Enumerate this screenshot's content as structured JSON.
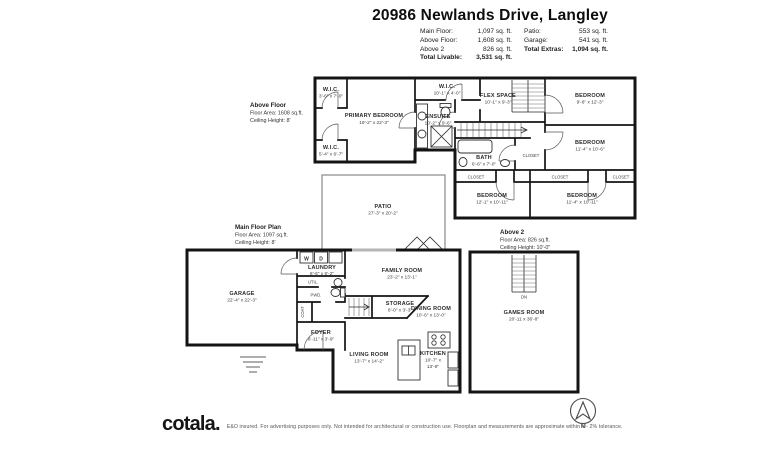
{
  "header": {
    "title": "20986 Newlands Drive, Langley",
    "stats_left": [
      {
        "label": "Main Floor:",
        "value": "1,097 sq. ft."
      },
      {
        "label": "Above Floor:",
        "value": "1,608 sq. ft."
      },
      {
        "label": "Above 2",
        "value": "826 sq. ft."
      },
      {
        "label": "Total Livable:",
        "value": "3,531 sq. ft."
      }
    ],
    "stats_right": [
      {
        "label": "Patio:",
        "value": "553 sq. ft."
      },
      {
        "label": "Garage:",
        "value": "541 sq. ft."
      },
      {
        "label": "Total Extras:",
        "value": "1,094 sq. ft."
      }
    ]
  },
  "plans": {
    "above": {
      "title": "Above Floor",
      "area": "Floor Area: 1608 sq.ft.",
      "ceiling": "Ceiling Height: 8'",
      "rooms": {
        "wic1": {
          "n": "W.I.C.",
          "d": "3'-6\" x 7'-0\""
        },
        "primary": {
          "n": "PRIMARY BEDROOM",
          "d": "19'-2\" x 22'-3\""
        },
        "wic2": {
          "n": "W.I.C.",
          "d": "5'-4\" x 6'-7\""
        },
        "wic3": {
          "n": "W.I.C.",
          "d": "10'-1\" x 4'-0\""
        },
        "ensuite": {
          "n": "ENSUITE",
          "d": "10'-2\" x 9'-6\""
        },
        "flex": {
          "n": "FLEX SPACE",
          "d": "10'-1\" x 9'-3\""
        },
        "bed1": {
          "n": "BEDROOM",
          "d": "9'-6\" x 12'-3\""
        },
        "bed2": {
          "n": "BEDROOM",
          "d": "11'-4\" x 10'-6\""
        },
        "bath": {
          "n": "BATH",
          "d": "6'-6\" x 7'-0\""
        },
        "bed3": {
          "n": "BEDROOM",
          "d": "12'-1\" x 10'-11\""
        },
        "bed4": {
          "n": "BEDROOM",
          "d": "11'-4\" x 10'-11\""
        },
        "closet": "CLOSET"
      }
    },
    "main": {
      "title": "Main Floor Plan",
      "area": "Floor Area: 1097 sq.ft.",
      "ceiling": "Ceiling Height: 8'",
      "rooms": {
        "patio": {
          "n": "PATIO",
          "d": "27'-3\" x 20'-2\""
        },
        "garage": {
          "n": "GARAGE",
          "d": "22'-4\" x 22'-3\""
        },
        "laundry": {
          "n": "LAUNDRY",
          "d": "8'-6\" x 6'-2\""
        },
        "util": "UTIL.",
        "pwd": "PWD.",
        "coat": "COAT",
        "washer": "W",
        "dryer": "D",
        "foyer": {
          "n": "FOYER",
          "d": "6'-11\" x 3'-9\""
        },
        "storage": {
          "n": "STORAGE",
          "d": "8'-0\" x 3'-3\""
        },
        "family": {
          "n": "FAMILY ROOM",
          "d": "23'-2\" x 13'-1\""
        },
        "dining": {
          "n": "DINING ROOM",
          "d": "10'-6\" x 13'-0\""
        },
        "living": {
          "n": "LIVING ROOM",
          "d": "13'-7\" x 14'-2\""
        },
        "kitchen": {
          "n": "KITCHEN",
          "d": "10'-7\" x",
          "d2": "13'-9\""
        }
      }
    },
    "above2": {
      "title": "Above 2",
      "area": "Floor Area: 826 sq.ft.",
      "ceiling": "Ceiling Height: 10'-0\"",
      "rooms": {
        "games": {
          "n": "GAMES ROOM",
          "d": "20'-11 x 36'-8\""
        },
        "dn": "DN"
      }
    }
  },
  "footer": {
    "logo": "cotala.",
    "disclaimer": "E&O insured. For advertising purposes only. Not intended for architectural or construction use. Floorplan and measurements are approximate within +/- 2% tolerance.",
    "compass_n": "N"
  }
}
